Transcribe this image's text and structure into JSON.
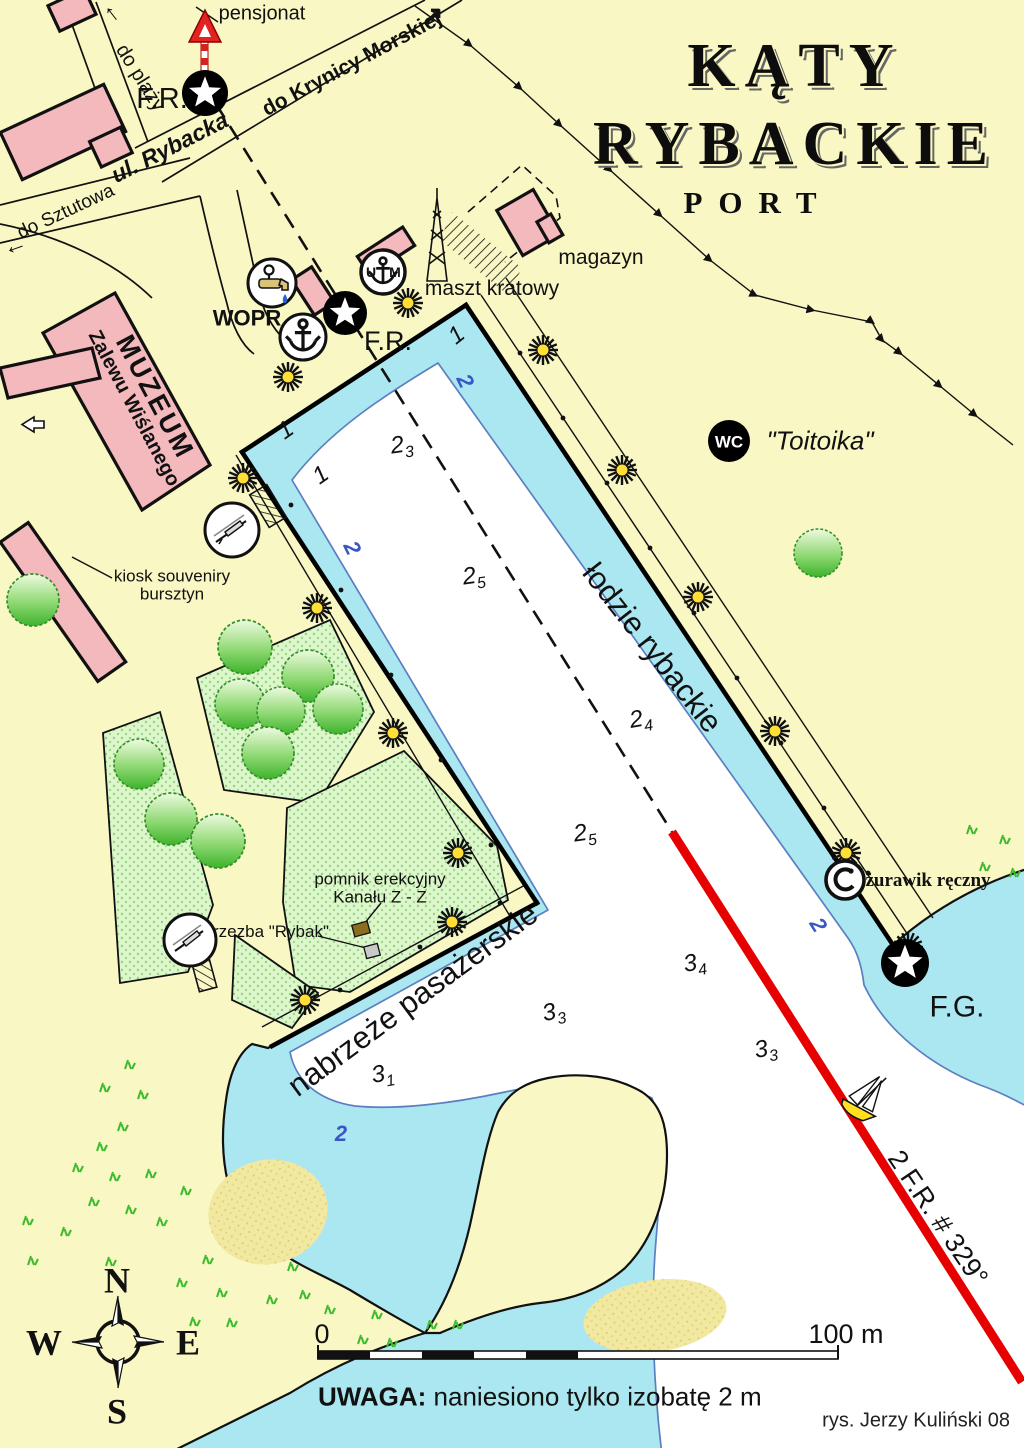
{
  "map_title": {
    "line1": "KĄTY",
    "line2": "RYBACKIE",
    "subtitle": "PORT"
  },
  "roads": {
    "pensjonat": "pensjonat",
    "do_plazy": "do plaży",
    "do_krynicy": "do Krynicy Morskiej",
    "ul_rybacka": "ul. Rybacka",
    "do_sztutowa": "do Sztutowa"
  },
  "arrows": {
    "northeast": "↗",
    "up": "↑",
    "left": "←"
  },
  "lights": {
    "fr_top": "F.R.",
    "fr_basin": "F.R.",
    "fg": "F.G.",
    "leading_line": "2 F.R. # 329°"
  },
  "landmarks": {
    "wopr": "WOPR",
    "um_left": "U",
    "um_right": "M",
    "wc": "WC",
    "wc_name": "\"Toitoika\"",
    "maszt_kratowy": "maszt kratowy",
    "magazyn": "magazyn",
    "muzeum_line1": "MUZEUM",
    "muzeum_line2": "Zalewu Wiślanego",
    "kiosk_line1": "kiosk souveniry",
    "kiosk_line2": "bursztyn",
    "pomnik_line1": "pomnik erekcyjny",
    "pomnik_line2": "Kanału Z - Z",
    "rzezba": "rzezba \"Rybak\"",
    "zurawik": "żurawik ręczny"
  },
  "quays": {
    "lodzie_rybackie": "łodzie rybackie",
    "nabrzeze": "nabrzeże pasażerskie"
  },
  "depths": [
    {
      "v": "1",
      "s": ""
    },
    {
      "v": "1",
      "s": ""
    },
    {
      "v": "1",
      "s": ""
    },
    {
      "v": "2",
      "s": "3"
    },
    {
      "v": "2",
      "s": "5"
    },
    {
      "v": "2",
      "s": "4"
    },
    {
      "v": "2",
      "s": "5"
    },
    {
      "v": "3",
      "s": "4"
    },
    {
      "v": "3",
      "s": "3"
    },
    {
      "v": "3",
      "s": "3"
    },
    {
      "v": "3",
      "s": "1"
    }
  ],
  "isobath_labels": [
    "2",
    "2",
    "2",
    "2"
  ],
  "note": {
    "label": "UWAGA:",
    "text": " naniesiono tylko izobatę 2 m"
  },
  "scale": {
    "start": "0",
    "end": "100 m"
  },
  "compass": {
    "north": "N",
    "west": "W",
    "east": "E",
    "south": "S"
  },
  "credit": "rys. Jerzy Kuliński 08",
  "colors": {
    "land": "#f9f7c3",
    "water": "#abe7f0",
    "deep": "#ffffff",
    "building": "#f4b9bd",
    "lawn": "#def6cb",
    "leading_line_red": "#e60000",
    "isobath_blue": "#5b7fc0",
    "lamp_yellow": "#ffdf36"
  }
}
